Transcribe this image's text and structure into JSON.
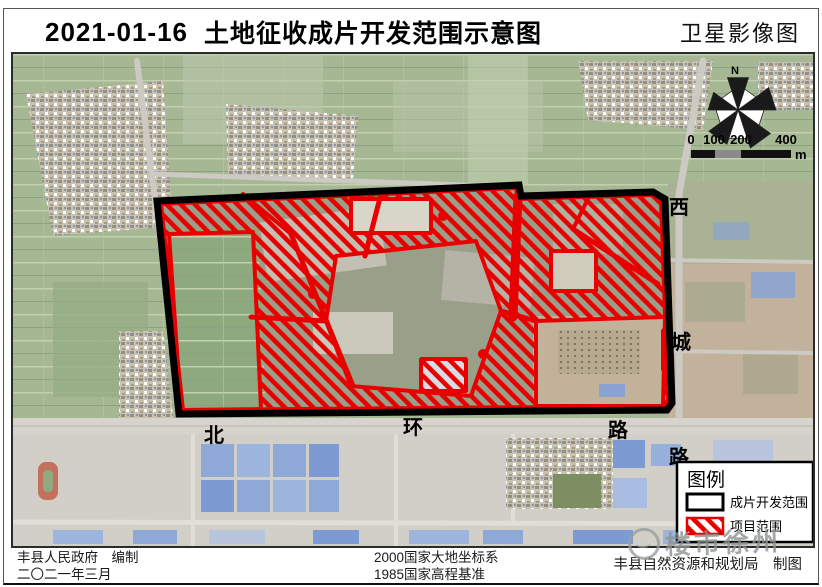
{
  "title": {
    "date": "2021-01-16",
    "main": "土地征收成片开发范围示意图",
    "right": "卫星影像图"
  },
  "map": {
    "road_labels": {
      "north_ring": [
        "北",
        "环",
        "路"
      ],
      "xicheng": [
        "西",
        "城",
        "路"
      ]
    },
    "compass": {
      "north": "N"
    },
    "scalebar": {
      "ticks": [
        "0",
        "100",
        "200",
        "400"
      ],
      "unit": "m"
    }
  },
  "legend": {
    "title": "图例",
    "items": [
      {
        "label": "成片开发范围",
        "swatch": "black-outline"
      },
      {
        "label": "项目范围",
        "swatch": "red-hatch"
      }
    ]
  },
  "footer": {
    "publisher": "丰县人民政府　编制",
    "date": "二〇二一年三月",
    "datum1": "2000国家大地坐标系",
    "datum2": "1985国家高程基准",
    "cartographer": "丰县自然资源和规划局　制图"
  },
  "watermark": {
    "text": "楼市徐州"
  },
  "colors": {
    "boundary": "#000000",
    "project_red": "#e80000",
    "farmland": "#a5b793",
    "bare_land": "#c2b29b",
    "road": "#ceccc5",
    "blue_roof": "#8ea9d8"
  }
}
